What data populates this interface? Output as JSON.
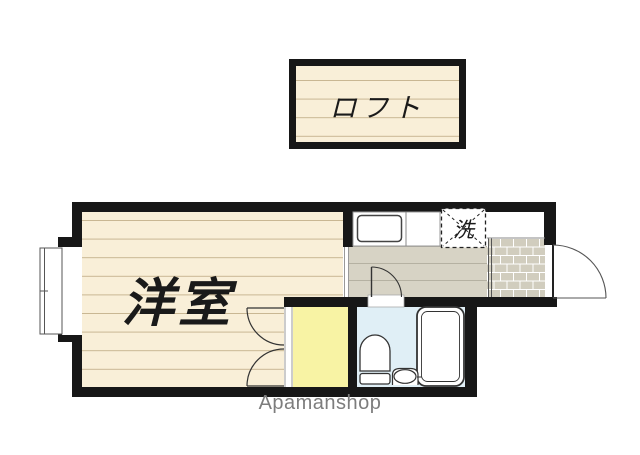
{
  "loft": {
    "label": "ロフト"
  },
  "main_floor": {
    "western_room_label": "洋室",
    "washer_label": "洗"
  },
  "watermark": "Apamanshop",
  "colors": {
    "wall": "#171717",
    "flooring": "#f9efd8",
    "flooring_line": "#c8b692",
    "hallway": "#d7d3c5",
    "hallway_line": "#b5b1a2",
    "closet": "#f8f3a4",
    "bathroom": "#e0eff6",
    "entrance_brick": "#d1cdbe",
    "brick_mortar": "#ffffff",
    "fixture_line": "#333333",
    "watermark_text": "#7d7d7d"
  }
}
